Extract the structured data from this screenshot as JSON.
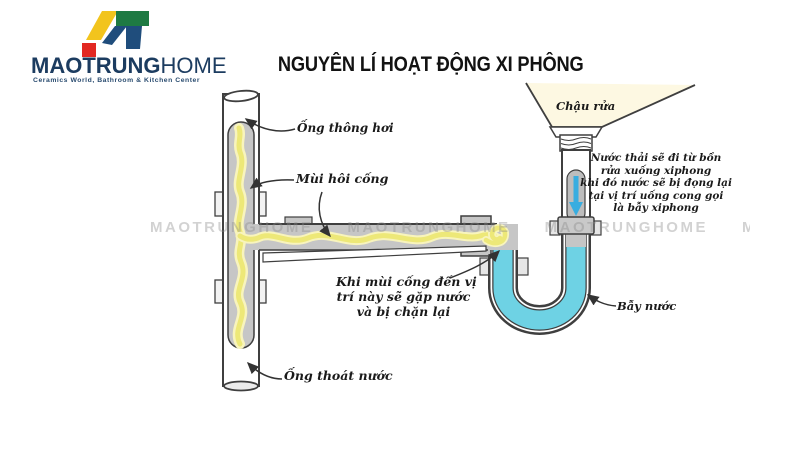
{
  "brand": {
    "name_primary": "MAOTRUNG",
    "name_secondary": "HOME",
    "tagline": "Ceramics World, Bathroom & Kitchen Center",
    "colors": {
      "navy": "#1c3c60",
      "yellow": "#f2c41d",
      "green": "#1e7a43",
      "red": "#e22822",
      "blue": "#1f4d7c"
    }
  },
  "title": "NGUYÊN LÍ HOẠT ĐỘNG XI PHÔNG",
  "watermark": "MAOTRUNGHOME",
  "diagram": {
    "labels": {
      "vent_pipe": "Ống thông hơi",
      "sewer_smell": "Mùi hôi cống",
      "sink": "Chậu rửa",
      "water_trap": "Bẫy nước",
      "drain_pipe": "Ống thoát nước"
    },
    "notes": {
      "right": [
        "Nước thải sẽ đi từ bồn",
        "rửa xuống xiphong",
        "khi đó nước sẽ bị đọng lại",
        "tại vị trí uống cong gọi",
        "là bẫy xiphong"
      ],
      "middle": [
        "Khi mùi cống đến vị",
        "trí này sẽ gặp nước",
        "và bị chặn lại"
      ]
    },
    "colors": {
      "water": "#6ed2e4",
      "smell": "#ede878",
      "smell_halo": "#f8f4bd",
      "pipe_fill": "#c6c6c6",
      "outline": "#3f3f3f",
      "basin": "#fdf8e2",
      "flow_arrow": "#38ade0"
    }
  }
}
